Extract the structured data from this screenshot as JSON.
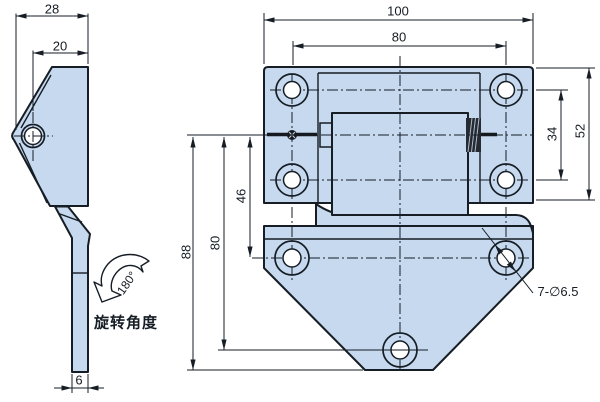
{
  "colors": {
    "part_fill": "#c6d9ee",
    "line": "#161d25",
    "background": "#ffffff"
  },
  "side_view": {
    "dim_overall_depth": "28",
    "dim_hole_offset": "20",
    "dim_arm_thickness": "6",
    "rotation_angle": "180°",
    "rotation_caption": "旋转角度"
  },
  "front_view": {
    "dim_overall_width": "100",
    "dim_hole_spacing_width": "80",
    "dim_leaf_height": "52",
    "dim_hole_row_spacing": "34",
    "dim_hole_row_offset": "46",
    "dim_bottom_hole_offset": "80",
    "dim_overall_height": "88",
    "hole_callout": "7-∅6.5"
  }
}
